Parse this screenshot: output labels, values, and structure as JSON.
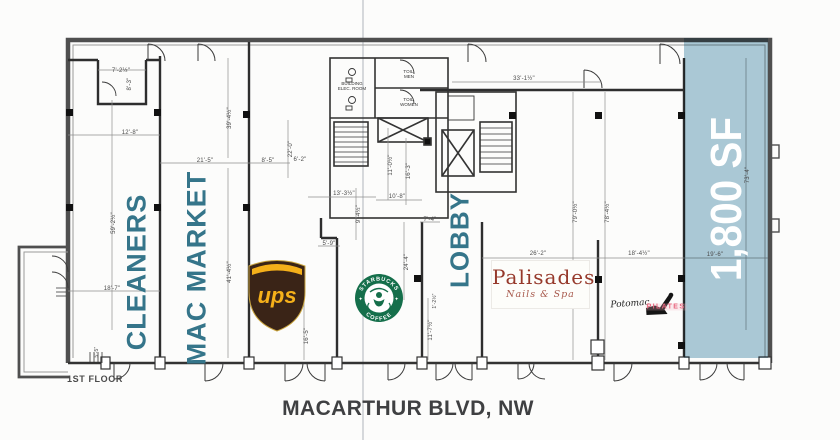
{
  "page": {
    "floor_label": "1ST FLOOR",
    "street_label": "MACARTHUR BLVD, NW"
  },
  "highlight": {
    "area_label": "1,800 SF",
    "fill_color": "#a3c6d5",
    "text_color": "#ffffff"
  },
  "tenants": {
    "cleaners": "CLEANERS",
    "mac_market": "MAC MARKET",
    "lobby": "LOBBY",
    "ups": "ups",
    "starbucks_top": "STARBUCKS",
    "starbucks_bottom": "COFFEE",
    "palisades_name": "Palisades",
    "palisades_sub": "Nails & Spa",
    "pilates_script": "Potomac",
    "pilates_word": "PILATES",
    "label_color": "#35758a",
    "ups_brown": "#3a2417",
    "ups_gold": "#f5b01a",
    "starbucks_green": "#156f4b",
    "palisades_red": "#96392b",
    "pilates_pink": "#e8677f"
  },
  "core_labels": {
    "elec": "BUILDING ELEC. ROOM",
    "toil_men": "TOIL. MEN",
    "toil_women": "TOIL. WOMEN"
  },
  "dims": {
    "d1": "7'-2½\"",
    "d2": "8'-3\"",
    "d3": "12'-8\"",
    "d4": "21'-5\"",
    "d5": "8'-5\"",
    "d6": "39'-4½\"",
    "d7": "59'-2½\"",
    "d8": "18'-7\"",
    "d9": "41'-4½\"",
    "d10": "22'-0\"",
    "d11": "6'-2\"",
    "d12": "13'-3½\"",
    "d13": "10'-8\"",
    "d14": "9'-4½\"",
    "d15": "11'-0½\"",
    "d16": "16'-3\"",
    "d17": "5'-9\"",
    "d18": "16'-5\"",
    "d19": "24'-4\"",
    "d20": "11'-7½\"",
    "d21": "1'-2½\"",
    "d22": "7'-4\"",
    "d23": "33'-1½\"",
    "d24": "79'-0½\"",
    "d25": "78'-4½\"",
    "d26": "26'-2\"",
    "d27": "18'-4½\"",
    "d28": "19'-6\"",
    "d29": "73'-4\"",
    "d30": "5'-5\""
  }
}
